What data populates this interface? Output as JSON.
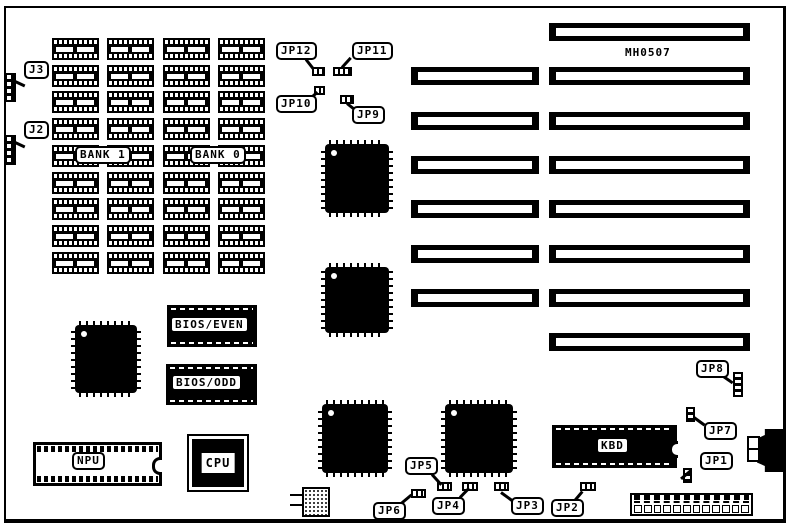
{
  "board": {
    "model": "MH0507",
    "colors": {
      "foreground": "#000000",
      "background": "#ffffff"
    }
  },
  "labels": {
    "j3": "J3",
    "j2": "J2",
    "jp1": "JP1",
    "jp2": "JP2",
    "jp3": "JP3",
    "jp4": "JP4",
    "jp5": "JP5",
    "jp6": "JP6",
    "jp7": "JP7",
    "jp8": "JP8",
    "jp9": "JP9",
    "jp10": "JP10",
    "jp11": "JP11",
    "jp12": "JP12",
    "bank1": "BANK 1",
    "bank0": "BANK 0",
    "bios_even": "BIOS/EVEN",
    "bios_odd": "BIOS/ODD",
    "npu": "NPU",
    "cpu": "CPU",
    "kbd": "KBD"
  },
  "memory": {
    "rows": 9,
    "cols": 4
  },
  "slots": {
    "long_count": 8,
    "short_count": 6
  },
  "power_connector": {
    "pin_count": 12
  }
}
